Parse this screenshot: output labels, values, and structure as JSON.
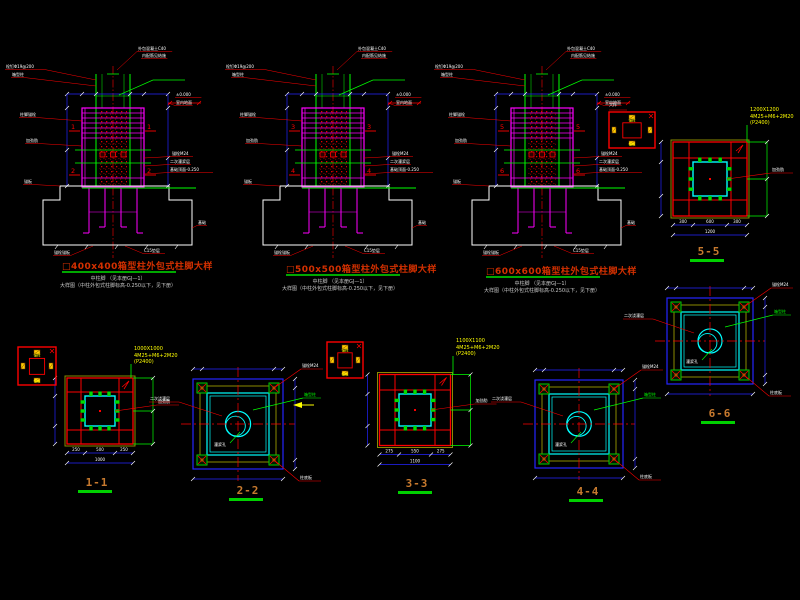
{
  "canvas": {
    "background": "#000000"
  },
  "colors": {
    "red": "#ff0000",
    "magenta": "#ff00ff",
    "green": "#00ff00",
    "cyan": "#00ffff",
    "blue": "#2424ff",
    "white": "#ffffff",
    "yellow": "#ffff00",
    "olive": "#8a8a00",
    "title_red": "#d43000",
    "label_orange": "#c87a2e",
    "underline_green": "#00c000",
    "concrete_dot_red": "#e00000"
  },
  "elevations": [
    {
      "id": "d400",
      "title": "□400x400箱型柱外包式柱脚大样",
      "note1": "中柱脚 （见本册GJ—1）",
      "note2": "大样图（中柱外包式柱脚标高-0.250以下，见下册）",
      "marker_top": "1",
      "marker_bottom": "2"
    },
    {
      "id": "d500",
      "title": "□500x500箱型柱外包式柱脚大样",
      "note1": "中柱脚 （见本册GJ—1）",
      "note2": "大样图（中柱外包式柱脚标高-0.250以下，见下册）",
      "marker_top": "3",
      "marker_bottom": "4"
    },
    {
      "id": "d600",
      "title": "□600x600箱型柱外包式柱脚大样",
      "note1": "中柱脚 （见本册GJ—1）",
      "note2": "大样图（中柱外包式柱脚标高-0.250以下，见下册）",
      "marker_top": "5",
      "marker_bottom": "6"
    }
  ],
  "elevation_annotations": [
    {
      "t": "栓钉Φ19@200",
      "dx": -108,
      "dy": 68,
      "ex": -17,
      "ey": 80
    },
    {
      "t": "箱型柱",
      "dx": -102,
      "dy": 76,
      "ex": -17,
      "ey": 86
    },
    {
      "t": "外包混凝土C40",
      "dx": 24,
      "dy": 50,
      "ex": 4,
      "ey": 70
    },
    {
      "t": "内配筋见结施",
      "dx": 28,
      "dy": 57
    },
    {
      "t": "±0.000",
      "dx": 62,
      "dy": 96
    },
    {
      "t": "室内地面",
      "dx": 62,
      "dy": 104,
      "ex": 55,
      "ey": 103
    },
    {
      "t": "柱脚锚栓",
      "dx": -94,
      "dy": 116,
      "ex": -31,
      "ey": 121
    },
    {
      "t": "加劲肋",
      "dx": -88,
      "dy": 142,
      "ex": -31,
      "ey": 146
    },
    {
      "t": "锚栓M24",
      "dx": 58,
      "dy": 155,
      "ex": 31,
      "ey": 158
    },
    {
      "t": "二次灌浆层",
      "dx": 56,
      "dy": 163,
      "ex": 31,
      "ey": 166
    },
    {
      "t": "基础顶面-0.250",
      "dx": 56,
      "dy": 171,
      "ex": 31,
      "ey": 174
    },
    {
      "t": "锚板",
      "dx": -90,
      "dy": 183,
      "ex": -53,
      "ey": 186
    },
    {
      "t": "基础",
      "dx": 84,
      "dy": 224,
      "ex": 79,
      "ey": 228
    },
    {
      "t": "C15垫层",
      "dx": 30,
      "dy": 252,
      "ex": 12,
      "ey": 246
    },
    {
      "t": "锚栓锚板",
      "dx": -60,
      "dy": 254,
      "ex": -20,
      "ey": 246
    }
  ],
  "plans": [
    {
      "id": "1-1",
      "label": "1-1",
      "type": "grid",
      "callout": [
        "1000X1000",
        "4M25+M6+2M20",
        "(P2400)"
      ],
      "dims": {
        "segs": [
          "250",
          "500",
          "250"
        ],
        "total": "1000"
      }
    },
    {
      "id": "2-2",
      "label": "2-2",
      "type": "plate"
    },
    {
      "id": "3-3",
      "label": "3-3",
      "type": "grid",
      "callout": [
        "1100X1100",
        "4M25+M6+2M20",
        "(P2400)"
      ],
      "dims": {
        "segs": [
          "275",
          "550",
          "275"
        ],
        "total": "1100"
      }
    },
    {
      "id": "4-4",
      "label": "4-4",
      "type": "plate"
    },
    {
      "id": "5-5",
      "label": "5-5",
      "type": "grid",
      "callout": [
        "1200X1200",
        "4M25+M6+2M20",
        "(P2400)"
      ],
      "dims": {
        "segs": [
          "300",
          "600",
          "300"
        ],
        "total": "1200"
      }
    },
    {
      "id": "6-6",
      "label": "6-6",
      "type": "plate"
    }
  ],
  "plan_annotations": {
    "stiffener": "加劲肋",
    "anchor": "锚栓M24",
    "base_plate": "柱底板",
    "column": "箱型柱",
    "grout_hole": "灌浆孔",
    "second_pour": "二次浇灌层"
  },
  "keybox": {
    "top_label": "锚栓",
    "bottom_label": "锚板",
    "caption": "大样"
  }
}
